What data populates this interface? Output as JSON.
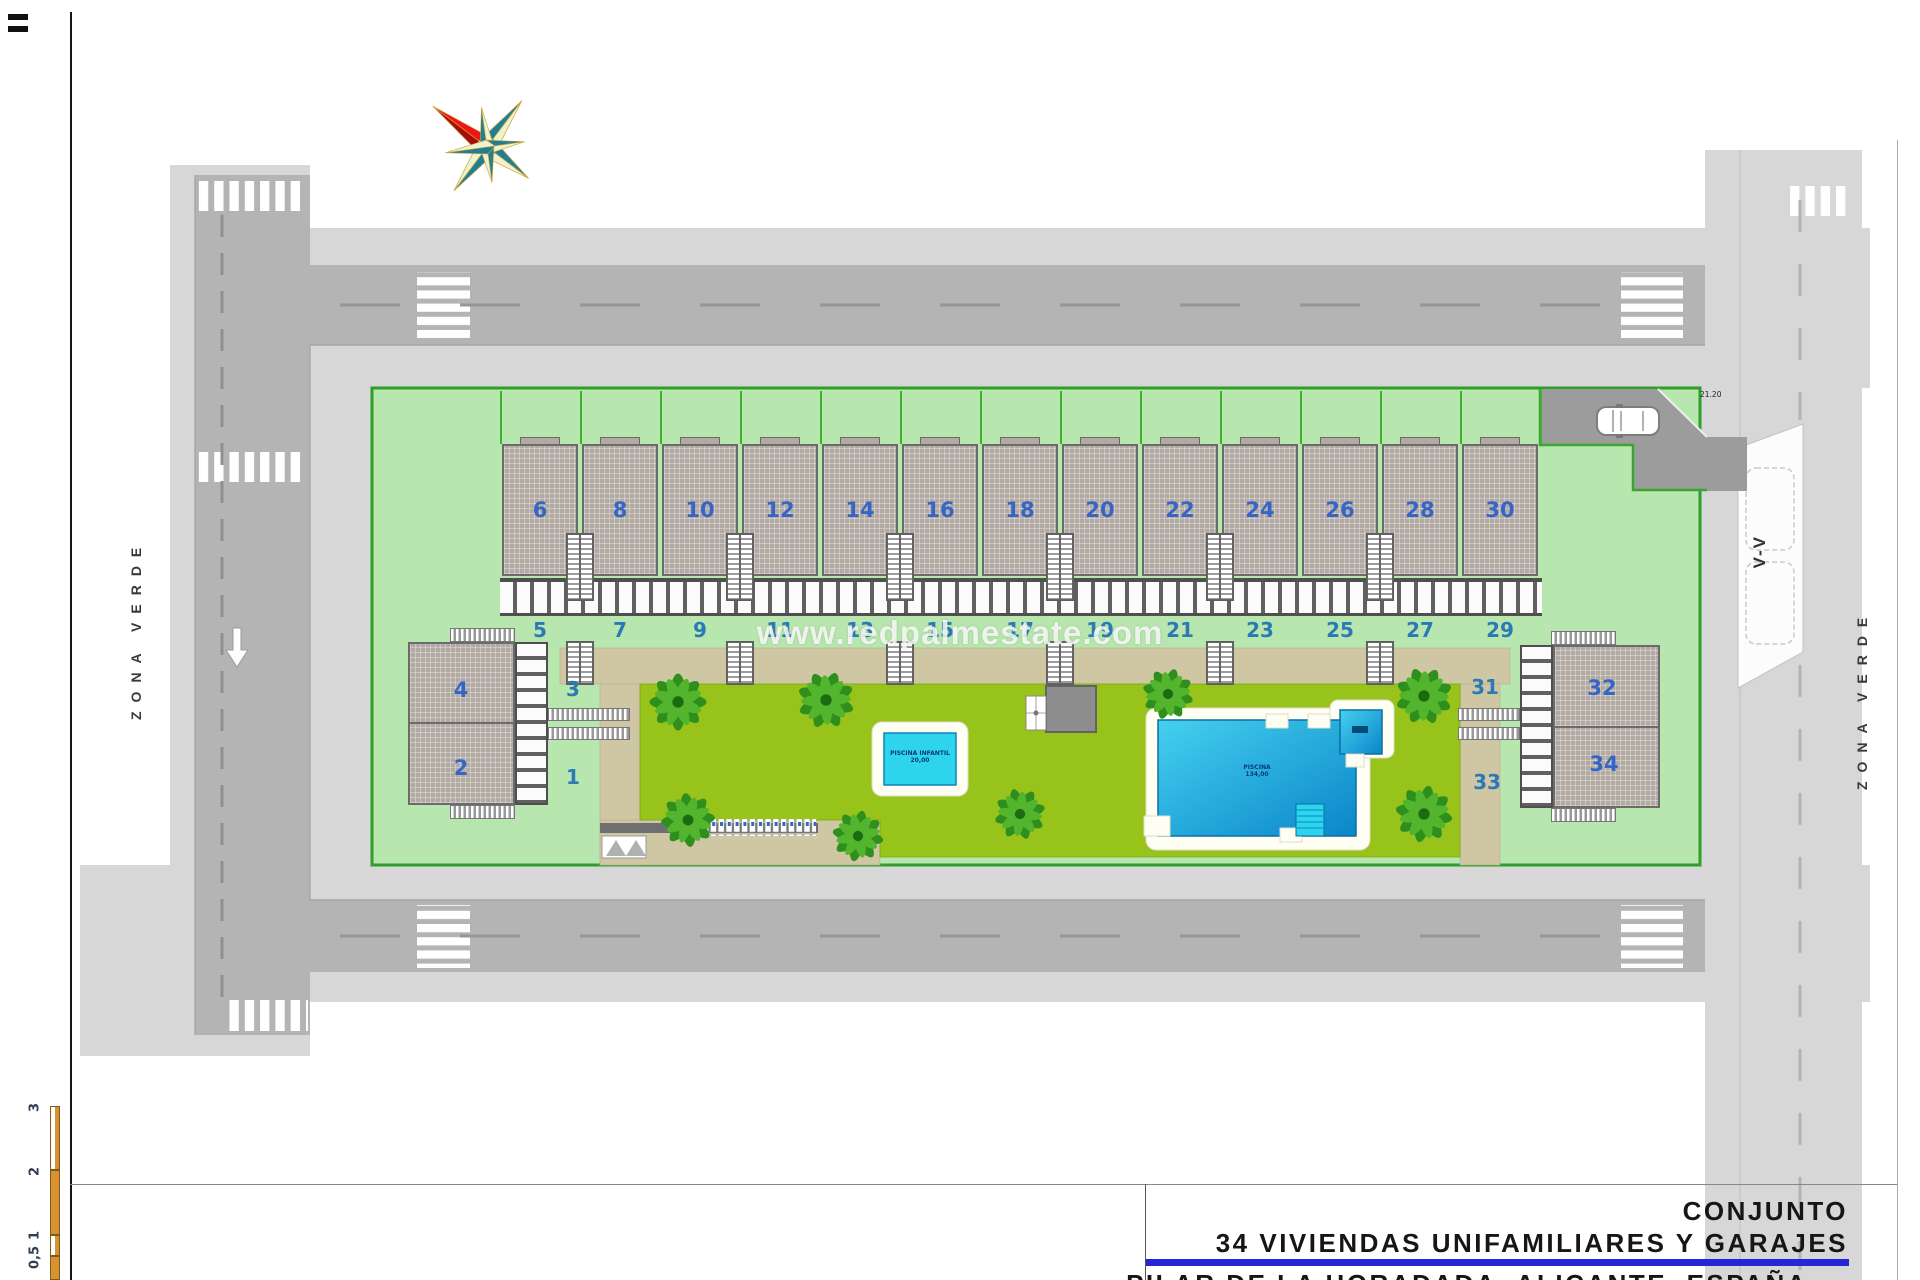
{
  "watermark": "www.redpalmestate.com",
  "title_block": {
    "line1": "CONJUNTO",
    "line2": "34 VIVIENDAS UNIFAMILIARES Y GARAJES",
    "line3": "PILAR DE LA HORADADA, ALICANTE, ESPAÑA"
  },
  "zones": {
    "left": "ZONA VERDE",
    "right": "ZONA VERDE"
  },
  "markers": {
    "section": "V-V",
    "dimension": "21.20"
  },
  "scale_bar": {
    "labels": [
      "3",
      "2",
      "1",
      "0,5"
    ]
  },
  "pools": {
    "small": {
      "line1": "PISCINA INFANTIL",
      "line2": "20,00"
    },
    "large": {
      "line1": "PISCINA",
      "line2": "134,00"
    }
  },
  "houses": {
    "terrace_upper": [
      "6",
      "8",
      "10",
      "12",
      "14",
      "16",
      "18",
      "20",
      "22",
      "24",
      "26",
      "28",
      "30"
    ],
    "terrace_lower": [
      "5",
      "7",
      "9",
      "11",
      "13",
      "15",
      "17",
      "19",
      "21",
      "23",
      "25",
      "27",
      "29"
    ],
    "west": {
      "roof_upper": "4",
      "roof_lower": "2",
      "garden_upper": "3",
      "garden_lower": "1"
    },
    "east": {
      "roof_upper": "32",
      "roof_lower": "34",
      "garden_upper": "31",
      "garden_lower": "33"
    }
  },
  "colors": {
    "accent_blue": "#2626d6",
    "number_blue": "#3565c5",
    "plot_green": "#b7e6ae",
    "garden_green": "#98c31b",
    "road_gray": "#b4b4b4",
    "path_tan": "#cfc6a4",
    "pool_blue": "#17a8dc",
    "scale_orange": "#d8922f"
  }
}
